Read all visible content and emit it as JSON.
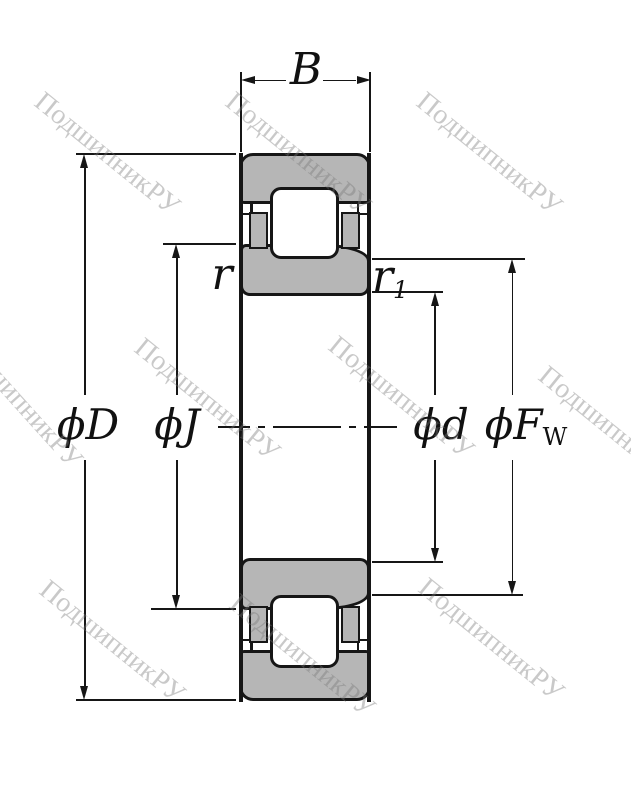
{
  "title": "Cylindrical roller bearing NJ-type cross-section drawing",
  "labels": {
    "width": "B",
    "phi": "ϕ",
    "outer_letter": "D",
    "pitch_letter": "J",
    "bore_letter": "d",
    "raceway_letter": "F",
    "raceway_subscript": "W",
    "chamfer_outer": "r",
    "chamfer_inner": "r",
    "chamfer_inner_subscript": "1"
  },
  "watermark": {
    "text": "ПодшипникРУ",
    "color": "#c8c8c8"
  },
  "colors": {
    "steel_fill": "#b6b6b6",
    "line": "#161616",
    "background": "#ffffff"
  }
}
